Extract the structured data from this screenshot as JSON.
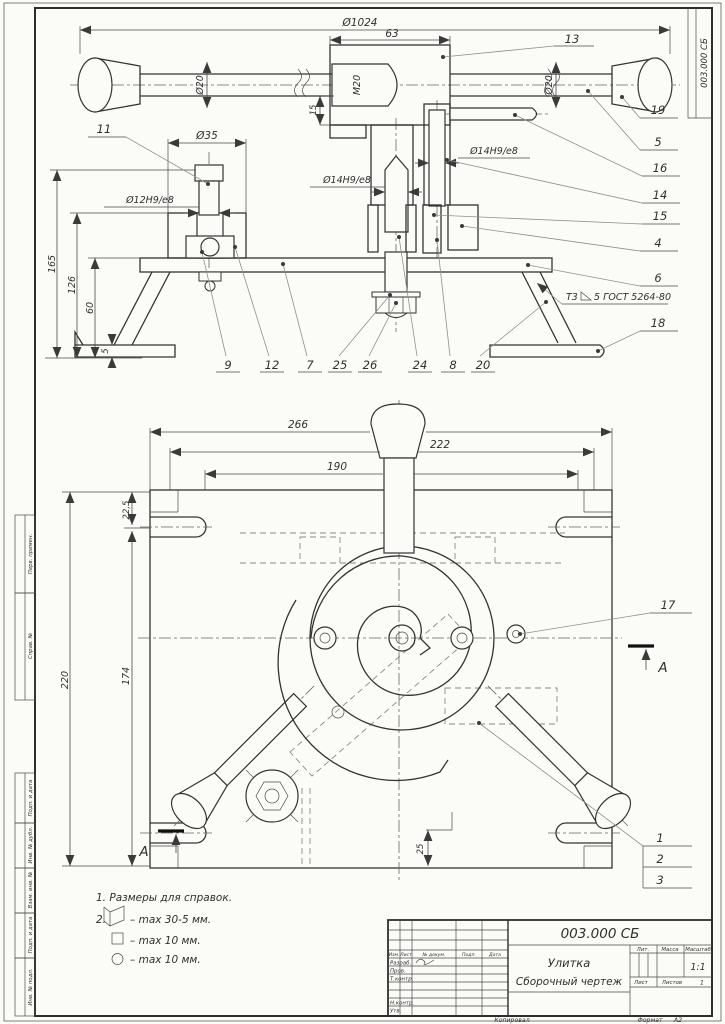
{
  "colors": {
    "paper": "#fbfbf8",
    "line": "#333333",
    "background": "#e8e8e6"
  },
  "frame": {
    "doc_number": "003.000 СБ",
    "stamps": [
      "Перв. примен.",
      "Справ. №",
      "Подп. и дата",
      "Инв. № дубл.",
      "Взам. инв. №",
      "Подп. и дата",
      "Инв. № подл."
    ]
  },
  "sv": {
    "dims": {
      "d1024": "Ø1024",
      "d63": "63",
      "m20": "М20",
      "d20l": "Ø20",
      "d20r": "Ø20",
      "d15": "15",
      "d35": "Ø35",
      "d12": "Ø12Н9/е8",
      "d14l": "Ø14Н9/е8",
      "d14r": "Ø14Н9/е8",
      "h165": "165",
      "h126": "126",
      "h60": "60",
      "t5": "5"
    },
    "weld": {
      "prefix": "Т3",
      "spec": "5 ГОСТ 5264-80"
    },
    "callouts": {
      "c4": "4",
      "c5": "5",
      "c6": "6",
      "c7": "7",
      "c8": "8",
      "c9": "9",
      "c11": "11",
      "c12": "12",
      "c13": "13",
      "c14": "14",
      "c15": "15",
      "c16": "16",
      "c18": "18",
      "c19": "19",
      "c20": "20",
      "c24": "24",
      "c25": "25",
      "c26": "26"
    }
  },
  "pv": {
    "dims": {
      "w266": "266",
      "w222": "222",
      "w190": "190",
      "t225": "22,5",
      "h220": "220",
      "h174": "174",
      "o25": "25"
    },
    "callouts": {
      "c1": "1",
      "c2": "2",
      "c3": "3",
      "c17": "17"
    },
    "section_letter": "А"
  },
  "notes": {
    "n1": "1. Размеры для справок.",
    "n2_num": "2.",
    "n2": "– max 30-5 мм.",
    "n3": "– max 10 мм.",
    "n4": "– max 10 мм."
  },
  "tb": {
    "doc_number": "003.000 СБ",
    "title": "Улитка",
    "subtitle": "Сборочный чертеж",
    "h_izm": "Изм.",
    "h_list": "Лист",
    "h_doc": "№ докум.",
    "h_sign": "Подп.",
    "h_date": "Дата",
    "r_razrab": "Разраб.",
    "r_prov": "Пров.",
    "r_tkontr": "Т.контр.",
    "r_nkontr": "Н.контр.",
    "r_utv": "Утв.",
    "lit": "Лит.",
    "massa": "Масса",
    "scale_label": "Масштаб",
    "scale": "1:1",
    "sheet_label": "Лист",
    "sheets_label": "Листов",
    "sheets_val": "1",
    "copied": "Копировал",
    "format_label": "Формат",
    "format_val": "А2"
  }
}
